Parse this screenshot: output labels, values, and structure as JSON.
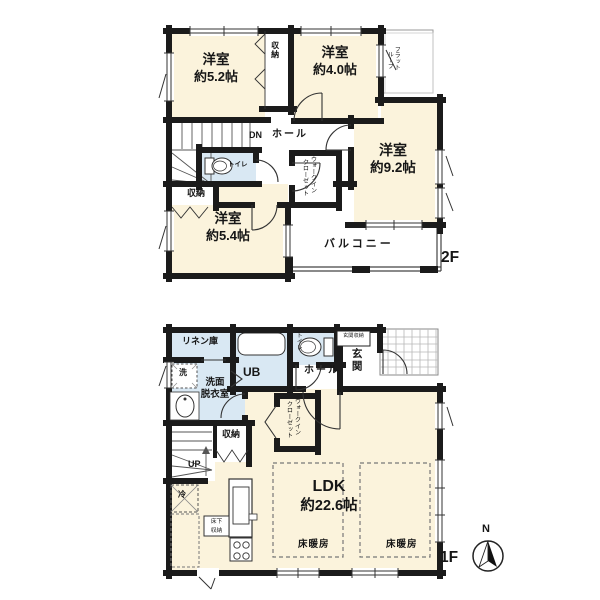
{
  "title": "2-story house floor plan",
  "colors": {
    "room_fill": "#fbf3dc",
    "wet_area_fill": "#d9e8f3",
    "wall": "#1b1b1b",
    "background": "#ffffff"
  },
  "floor2": {
    "tag": "2F",
    "room52": {
      "name": "洋室",
      "size": "約5.2帖"
    },
    "room40": {
      "name": "洋室",
      "size": "約4.0帖"
    },
    "room92": {
      "name": "洋室",
      "size": "約9.2帖"
    },
    "room54": {
      "name": "洋室",
      "size": "約5.4帖"
    },
    "closet_top": "収納",
    "closet_left": "収納",
    "toilet": "トイレ",
    "hall": "ホール",
    "dn": "DN",
    "wic_line1": "ウォークイン",
    "wic_line2": "クローゼット",
    "flat_roof_line1": "フラット",
    "flat_roof_line2": "ルーフ",
    "balcony": "バルコニー"
  },
  "floor1": {
    "tag": "1F",
    "linen": "リネン庫",
    "ub": "UB",
    "toilet": "トイレ",
    "entrance_storage": "玄関収納",
    "entrance": "玄関",
    "hall": "ホール",
    "washer": "洗",
    "sanitary_line1": "洗面",
    "sanitary_line2": "脱衣室",
    "closet": "収納",
    "up": "UP",
    "wic_line1": "ウォークイン",
    "wic_line2": "クローゼット",
    "ldk": {
      "name": "LDK",
      "size": "約22.6帖"
    },
    "fridge": "冷",
    "underfloor_line1": "床下",
    "underfloor_line2": "収納",
    "floor_heating": "床暖房",
    "compass_north": "N"
  }
}
